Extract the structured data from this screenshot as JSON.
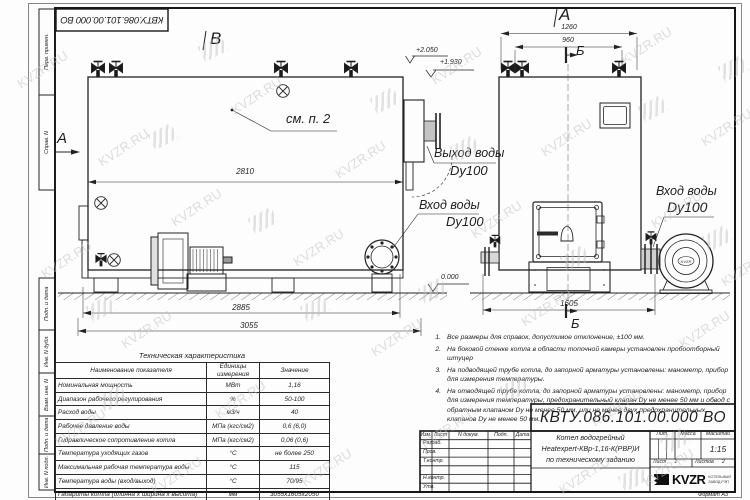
{
  "watermark": {
    "text": "KVZR.RU"
  },
  "sheet": {
    "top_stamp": "КВТУ.086.101.00.000  ВО",
    "format_label": "Формат   А3",
    "margin_labels": [
      "Перв. примен.",
      "Справ. N",
      "Подп. и дата",
      "Инв. N дубл.",
      "Взам. инв. N",
      "Подп. и дата",
      "Инв. N подл."
    ]
  },
  "views": {
    "left": {
      "view_label": "B",
      "section_arrow_label": "A",
      "see_note": "см. п. 2",
      "elev_top": "+2.050",
      "elev_mid": "+1.930",
      "elev_zero": "0.000",
      "dim_body": "2810",
      "dim_mid": "2885",
      "dim_overall": "3055",
      "outlet_title": "Выход воды",
      "outlet_dn": "Dy100",
      "inlet_title": "Вход воды",
      "inlet_dn": "Dy100"
    },
    "right": {
      "view_label": "A",
      "section_top": "Б",
      "section_bottom": "Б",
      "dim_outer": "1260",
      "dim_inner": "960",
      "dim_depth": "1605",
      "inlet_title": "Вход воды",
      "inlet_dn": "Dy100",
      "fan_badge": "KVZR"
    }
  },
  "notes": {
    "items": [
      {
        "num": "1.",
        "text": "Все размеры для справок, допустимое отклонение, ±100 мм."
      },
      {
        "num": "2.",
        "text": "На боковой стенке котла в области топочной камеры установлен пробоотборный штуцер"
      },
      {
        "num": "3.",
        "text": "На подводящей трубе котла, до запорной арматуры установлены: манометр, прибор для измерения температуры."
      },
      {
        "num": "4.",
        "text": "На отводящей трубе котла, до запорной арматуры установлены: манометр, прибор для измерения температуры, предохранительный клапан Dу не менее 50 мм и обвод с обратным клапаном Dу не менее 50 мм, или не менее двух предохранительных клапанов Dу не менее 50 мм."
      }
    ]
  },
  "tech_table": {
    "title": "Техническая характеристика",
    "headers": {
      "name": "Наименование показателя",
      "units": "Единицы измерения",
      "value": "Значение"
    },
    "rows": [
      {
        "name": "Номинальная мощность",
        "units": "МВт",
        "value": "1,16"
      },
      {
        "name": "Диапазон рабочего регулирования",
        "units": "%",
        "value": "50-100"
      },
      {
        "name": "Расход воды",
        "units": "м3/ч",
        "value": "40"
      },
      {
        "name": "Рабочее давление воды",
        "units": "МПа (кгс/см2)",
        "value": "0,6 (6,0)"
      },
      {
        "name": "Гидравлическое сопротивление котла",
        "units": "МПа (кгс/см2)",
        "value": "0,06 (0,6)"
      },
      {
        "name": "Температура уходящих газов",
        "units": "°С",
        "value": "не более 250"
      },
      {
        "name": "Максимальная рабочая температура воды",
        "units": "°С",
        "value": "115"
      },
      {
        "name": "Температура воды (вход/выход)",
        "units": "°С",
        "value": "70/95"
      },
      {
        "name": "Габариты котла (длинна х ширина х высота)",
        "units": "мм",
        "value": "3055х1605х2050"
      }
    ]
  },
  "title_block": {
    "doc_number": "КВТУ.086.101.00.000  ВО",
    "col_headers": [
      "Изм.",
      "Лист",
      "N докум.",
      "Подп.",
      "Дата"
    ],
    "row_labels": [
      "Разраб.",
      "Пров.",
      "Т.контр.",
      "Н.контр.",
      "Утв."
    ],
    "name_line1": "Котел водогрейный",
    "name_line2": "Heatexpert-КВр-1,16-К(РВР)И",
    "name_line3": "по техническому заданию",
    "lit_header": "Лит.",
    "mass_header": "Масса",
    "scale_header": "Масштаб",
    "scale_value": "1:15",
    "sheet_label": "Лист",
    "sheet_value": "1",
    "sheets_label": "Листов",
    "sheets_value": "2",
    "logo_text": "KVZR",
    "logo_sub1": "КОТЕЛЬНЫЙ",
    "logo_sub2": "ЗАВОД РЭП"
  }
}
